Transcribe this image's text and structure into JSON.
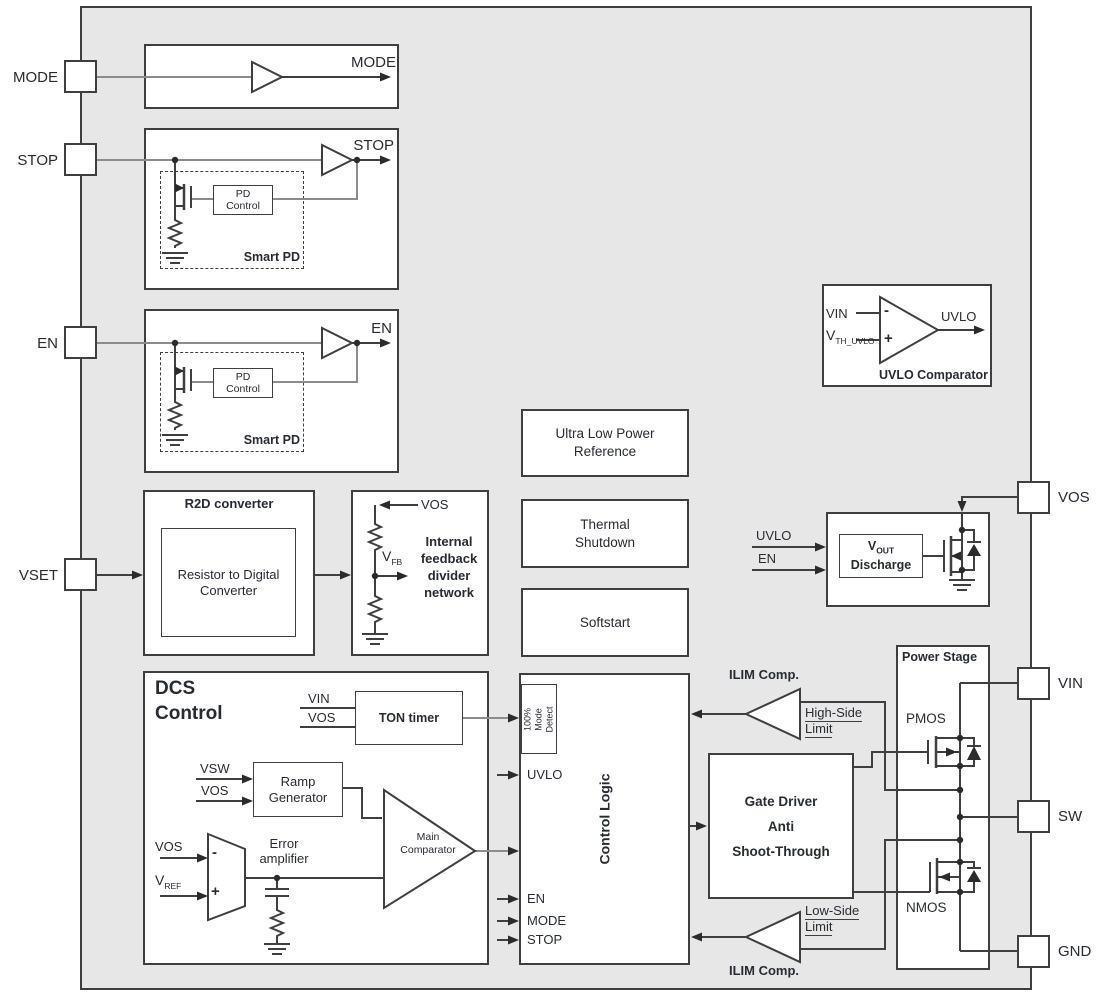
{
  "pins": {
    "mode": "MODE",
    "stop": "STOP",
    "en": "EN",
    "vset": "VSET",
    "vos": "VOS",
    "vin": "VIN",
    "sw": "SW",
    "gnd": "GND"
  },
  "mode_block": {
    "out": "MODE"
  },
  "stop_block": {
    "out": "STOP",
    "pd_control": "PD\nControl",
    "smart_pd": "Smart PD"
  },
  "en_block": {
    "out": "EN",
    "pd_control": "PD\nControl",
    "smart_pd": "Smart PD"
  },
  "r2d": {
    "title": "R2D converter",
    "body": "Resistor to Digital\nConverter"
  },
  "feedback": {
    "vos": "VOS",
    "v": "V",
    "sub": "FB",
    "title": "Internal\nfeedback\ndivider\nnetwork"
  },
  "reference": {
    "label": "Ultra Low Power\nReference"
  },
  "thermal": {
    "label": "Thermal\nShutdown"
  },
  "softstart": {
    "label": "Softstart"
  },
  "uvlo_cmp": {
    "in1": "VIN",
    "v": "V",
    "sub": "TH_UVLO",
    "minus": "-",
    "plus": "+",
    "out": "UVLO",
    "title": "UVLO Comparator"
  },
  "discharge": {
    "in1": "UVLO",
    "in2": "EN",
    "v": "V",
    "sub": "OUT",
    "word": "Discharge"
  },
  "dcs": {
    "title": "DCS\nControl",
    "ton": "TON timer",
    "ton_in1": "VIN",
    "ton_in2": "VOS",
    "ramp": "Ramp\nGenerator",
    "ramp_in1": "VSW",
    "ramp_in2": "VOS",
    "err_in1": "VOS",
    "err_v": "V",
    "err_sub": "REF",
    "minus": "-",
    "plus": "+",
    "err_label": "Error\namplifier",
    "main": "Main\nComparator"
  },
  "control_logic": {
    "title": "Control Logic",
    "detect": "100% Mode\nDetect",
    "uvlo": "UVLO",
    "en": "EN",
    "mode": "MODE",
    "stop": "STOP"
  },
  "gate_driver": {
    "label": "Gate Driver\nAnti\nShoot-Through"
  },
  "ilim_high": {
    "title": "ILIM Comp.",
    "l1": "High-Side",
    "l2": "Limit"
  },
  "ilim_low": {
    "title": "ILIM Comp.",
    "l1": "Low-Side",
    "l2": "Limit"
  },
  "power_stage": {
    "title": "Power Stage",
    "pmos": "PMOS",
    "nmos": "NMOS"
  },
  "colors": {
    "chip_fill": "#e7e7e7",
    "line": "#3f3f3f",
    "wire_light": "#8c8c8c",
    "text": "#272b33"
  }
}
